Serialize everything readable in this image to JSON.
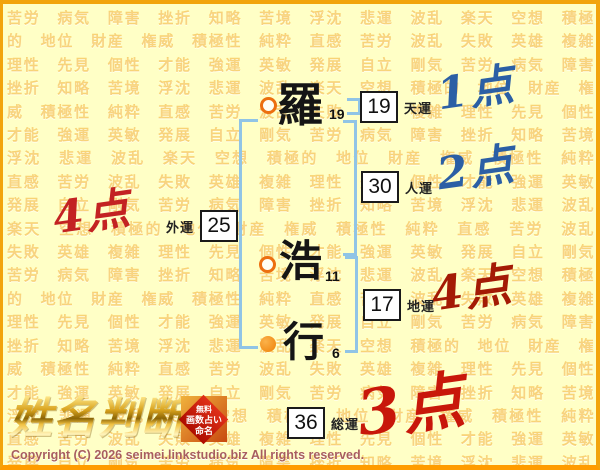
{
  "background": {
    "pattern_words": [
      "苦労",
      "病気",
      "障害",
      "挫折",
      "知略",
      "苦境",
      "浮沈",
      "悲運",
      "波乱",
      "楽天",
      "空想",
      "積極的",
      "地位",
      "財産",
      "権威",
      "積極性",
      "純粋",
      "直感",
      "苦労",
      "波乱",
      "失敗",
      "英雄",
      "複雑",
      "理性",
      "先見",
      "個性",
      "才能",
      "強運",
      "英敏",
      "発展",
      "自立",
      "剛気"
    ],
    "repeat": 8
  },
  "name": {
    "chars": [
      {
        "char": "羅",
        "strokes": "19"
      },
      {
        "char": "浩",
        "strokes": "11"
      },
      {
        "char": "行",
        "strokes": "6"
      }
    ]
  },
  "fortune": {
    "tenun": {
      "label": "天運",
      "value": "19"
    },
    "jinun": {
      "label": "人運",
      "value": "30"
    },
    "chiun": {
      "label": "地運",
      "value": "17"
    },
    "gaiun": {
      "label": "外運",
      "value": "25"
    },
    "souun": {
      "label": "総運",
      "value": "36"
    }
  },
  "scores": {
    "tenun": {
      "text": "1点",
      "color": "#2B5FA5"
    },
    "jinun": {
      "text": "2点",
      "color": "#2B5FA5"
    },
    "gaiun": {
      "text": "4点",
      "color": "#C32222"
    },
    "chiun": {
      "text": "4点",
      "color": "#A41A05"
    },
    "souun": {
      "text": "3点",
      "color": "#C8170A"
    }
  },
  "icons": {
    "surname_marker": "hollow-circle",
    "given_last_marker": "filled-circle"
  },
  "colors": {
    "page_background": "#FFFFC6",
    "border_orange": "#F2A40C",
    "bracket_blue": "#90C4E6",
    "marker_orange": "#EC6F10",
    "background_word_orange": "#F2A81A"
  },
  "branding": {
    "logo_text": "姓名判断",
    "stamp": {
      "line1": "無料",
      "line2": "画数占い",
      "line3": "命名"
    },
    "copyright": "Copyright (C) 2026 seimei.linkstudio.biz All rights reserved."
  }
}
